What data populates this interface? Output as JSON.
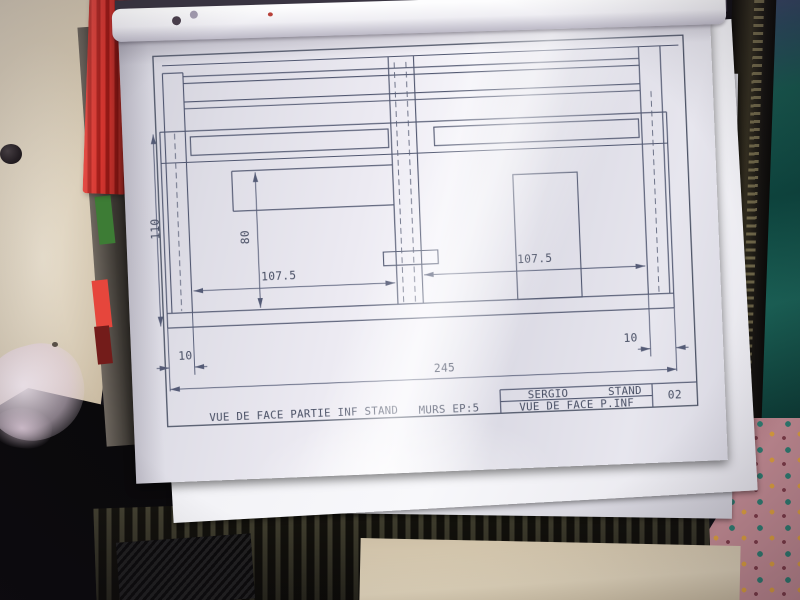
{
  "scene": {
    "setting": "photograph of a technical drawing sheet in a clear plastic sleeve lying in a dark binder",
    "objects": {
      "left_fabric": "beige cloth",
      "red_object": "red textured strip",
      "edge_segments": [
        "green",
        "red",
        "dark red"
      ],
      "top_right_fabric": "teal cloth",
      "bottom_right_fabric": "pink patterned cloth",
      "binder": "black binder with ribbed strap",
      "paper_stack": "white sheets stacked behind the top drawing"
    },
    "colors": {
      "paper": "#e6e5ed",
      "ink": "#49506a",
      "binder": "#0b0a0c",
      "fabric_beige": "#d6c9b2",
      "fabric_teal": "#14544c",
      "fabric_pink": "#c58d95",
      "red_object": "#c5262b"
    }
  },
  "drawing": {
    "annotation_title": "VUE DE FACE PARTIE INF STAND",
    "wall_thickness_note": "MURS EP:5",
    "title_block": {
      "author": "SERGIO",
      "project": "STAND",
      "view_label": "VUE DE FACE P.INF",
      "sheet_number": "02"
    },
    "dimensions": {
      "total_height": "110",
      "opening_height": "80",
      "left_bay_width": "107.5",
      "right_bay_width": "107.5",
      "total_width": "245",
      "left_offset": "10",
      "right_offset": "10"
    }
  }
}
